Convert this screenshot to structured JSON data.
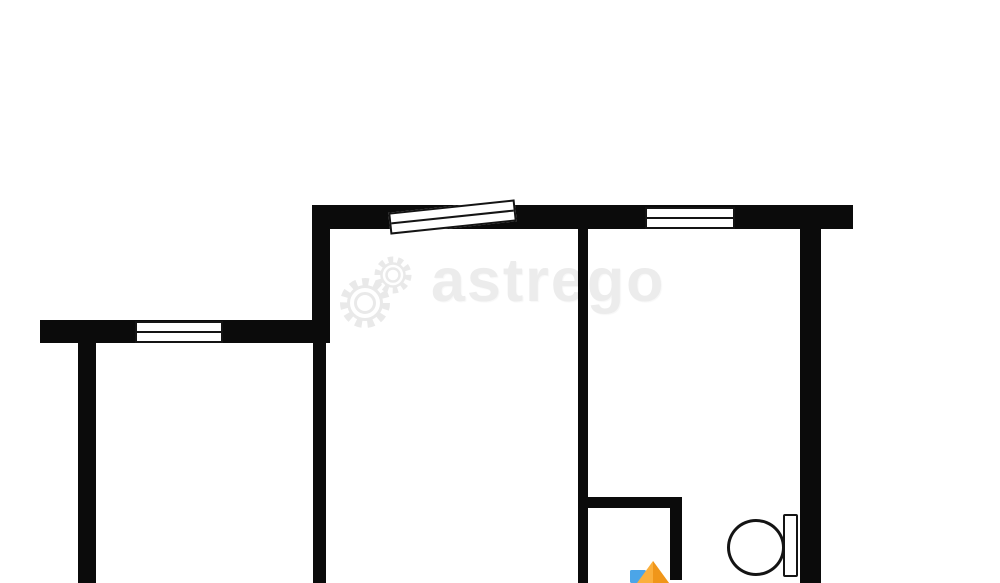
{
  "watermark": {
    "text": "astrego",
    "text_color": "#ececec",
    "gear_color": "#e9e9e9"
  },
  "plan": {
    "background_color": "#ffffff",
    "wall_color": "#0b0b0b",
    "outline_color": "#141414",
    "walls": [
      {
        "name": "outer-wall-top",
        "x": 312,
        "y": 205,
        "w": 541,
        "h": 24
      },
      {
        "name": "room-left-wall-upper",
        "x": 312,
        "y": 229,
        "w": 18,
        "h": 114
      },
      {
        "name": "room-left-wall-lower",
        "x": 313,
        "y": 343,
        "w": 13,
        "h": 240
      },
      {
        "name": "partition-wall-center",
        "x": 578,
        "y": 229,
        "w": 10,
        "h": 354
      },
      {
        "name": "outer-wall-right",
        "x": 800,
        "y": 229,
        "w": 21,
        "h": 354
      },
      {
        "name": "outer-wall-left-horizontal",
        "x": 40,
        "y": 320,
        "w": 290,
        "h": 23
      },
      {
        "name": "left-interior-wall",
        "x": 78,
        "y": 343,
        "w": 18,
        "h": 240
      },
      {
        "name": "wc-wall-top",
        "x": 578,
        "y": 497,
        "w": 94,
        "h": 11
      },
      {
        "name": "wc-wall-right",
        "x": 670,
        "y": 497,
        "w": 12,
        "h": 83
      }
    ],
    "windows": [
      {
        "name": "window-west",
        "x": 135,
        "y": 321,
        "w": 88,
        "h": 22,
        "rotate": 0
      },
      {
        "name": "window-north-slanted",
        "x": 389,
        "y": 206,
        "w": 127,
        "h": 22,
        "rotate": -6
      },
      {
        "name": "window-north-east",
        "x": 645,
        "y": 207,
        "w": 90,
        "h": 22,
        "rotate": 0
      }
    ],
    "toilet": {
      "bowl": {
        "x": 727,
        "y": 519,
        "w": 58,
        "h": 57
      },
      "tank": {
        "x": 783,
        "y": 514,
        "w": 15,
        "h": 63
      }
    },
    "logo": {
      "blue": "#4BA5E8",
      "orange_light": "#FBAF3C",
      "orange_dark": "#F0961A"
    }
  }
}
